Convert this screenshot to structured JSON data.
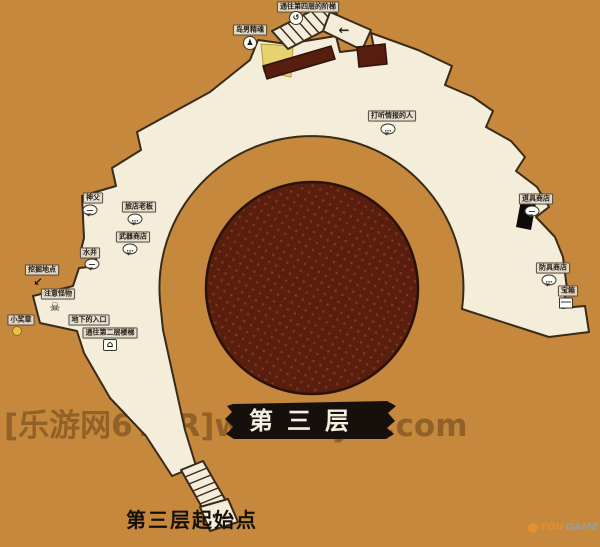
{
  "colors": {
    "background": "#c5883c",
    "floor": "#f4edda",
    "outline": "#3a2a18",
    "pit": "#5a1e0f",
    "pit_dot": "#7b3a1f",
    "carpet": "#571d0e",
    "accent_yellow": "#e6d26e",
    "banner": "#15100c",
    "banner_text": "#f5efe2",
    "watermark": "#5f3c14",
    "label_ink": "#241d14"
  },
  "banner": {
    "title": "第三层"
  },
  "start_point": {
    "label": "第三层起始点"
  },
  "watermark": {
    "text": "[乐游网6YER]www.6yer.com"
  },
  "logo": {
    "prefix": "YOU",
    "suffix": "GAME"
  },
  "icons": {
    "bubble": "…",
    "bubble-dash": "—",
    "skull": "☠",
    "coin": "",
    "person": "♟",
    "house": "⌂",
    "arrow": "↙",
    "box": "",
    "spiral": "↺",
    "arrow-left": "←"
  },
  "markers": [
    {
      "name": "stairs-to-fourth-floor",
      "label": "通往第四层的阶梯",
      "icon": "spiral",
      "lx": 308,
      "ly": 7,
      "ix": 296,
      "iy": 18
    },
    {
      "name": "island-spirit",
      "label": "岛男精魂",
      "icon": "person",
      "lx": 250,
      "ly": 30,
      "ix": 250,
      "iy": 43
    },
    {
      "name": "npc-info",
      "label": "打听情报的人",
      "icon": "bubble",
      "lx": 392,
      "ly": 116,
      "ix": 388,
      "iy": 129
    },
    {
      "name": "npc-priest",
      "label": "神父",
      "icon": "bubble-dash",
      "lx": 93,
      "ly": 198,
      "ix": 90,
      "iy": 210
    },
    {
      "name": "npc-innkeeper",
      "label": "旅店老板",
      "icon": "bubble",
      "lx": 139,
      "ly": 207,
      "ix": 135,
      "iy": 219
    },
    {
      "name": "npc-weapon-shop",
      "label": "武器商店",
      "icon": "bubble",
      "lx": 133,
      "ly": 237,
      "ix": 130,
      "iy": 249
    },
    {
      "name": "well",
      "label": "水井",
      "icon": "bubble-dash",
      "lx": 90,
      "ly": 253,
      "ix": 92,
      "iy": 264
    },
    {
      "name": "dig-spot",
      "label": "挖掘地点",
      "icon": "arrow",
      "lx": 42,
      "ly": 270,
      "ix": 38,
      "iy": 282
    },
    {
      "name": "monster-warning",
      "label": "注意怪物",
      "icon": "skull",
      "lx": 58,
      "ly": 294,
      "ix": 55,
      "iy": 307
    },
    {
      "name": "small-medal",
      "label": "小奖章",
      "icon": "coin",
      "lx": 21,
      "ly": 320,
      "ix": 17,
      "iy": 331
    },
    {
      "name": "underground-entrance",
      "label": "地下的入口",
      "icon": null,
      "lx": 89,
      "ly": 320
    },
    {
      "name": "stairs-to-second-floor",
      "label": "通往第二层楼梯",
      "icon": "house",
      "lx": 110,
      "ly": 333,
      "ix": 110,
      "iy": 345
    },
    {
      "name": "item-shop",
      "label": "道具商店",
      "icon": "bubble-dash",
      "lx": 536,
      "ly": 199,
      "ix": 532,
      "iy": 211
    },
    {
      "name": "armor-shop",
      "label": "防具商店",
      "icon": "bubble",
      "lx": 553,
      "ly": 268,
      "ix": 549,
      "iy": 280
    },
    {
      "name": "treasure-chest",
      "label": "宝箱",
      "icon": "box",
      "lx": 568,
      "ly": 291,
      "ix": 566,
      "iy": 303
    },
    {
      "name": "direction-arrow-top",
      "label": "",
      "icon": "arrow-left",
      "ix": 344,
      "iy": 31
    },
    {
      "name": "direction-arrow-start",
      "label": "",
      "icon": "arrow",
      "ix": 216,
      "iy": 515
    }
  ]
}
